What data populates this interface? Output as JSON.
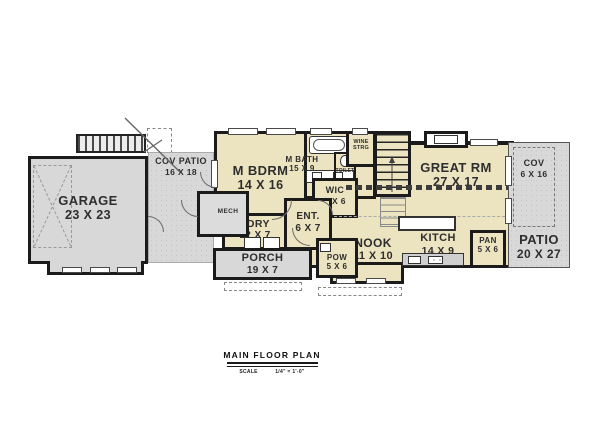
{
  "plan": {
    "title": "MAIN FLOOR PLAN",
    "scale_label": "SCALE",
    "scale_value": "1/4\" = 1'-0\""
  },
  "rooms": {
    "garage": {
      "name": "GARAGE",
      "dims": "23 X 23"
    },
    "cov_patio": {
      "name": "COV PATIO",
      "dims": "16 X 18"
    },
    "mech": {
      "name": "MECH"
    },
    "m_bdrm": {
      "name": "M BDRM",
      "dims": "14 X 16"
    },
    "m_bath": {
      "name": "M BATH",
      "dims": "15 X 9"
    },
    "toilet": {
      "name": "TOILET"
    },
    "wine_strg": {
      "line1": "WINE",
      "line2": "STRG"
    },
    "wic": {
      "name": "WIC",
      "dims": "9 X 6"
    },
    "great_rm": {
      "name": "GREAT RM",
      "dims": "27 X 17"
    },
    "ldry": {
      "name": "LDRY",
      "dims": "12 X 7"
    },
    "ent": {
      "name": "ENT.",
      "dims": "6 X 7"
    },
    "nook": {
      "name": "NOOK",
      "dims": "11 X 10"
    },
    "kitch": {
      "name": "KITCH",
      "dims": "14 X 9"
    },
    "pan": {
      "name": "PAN",
      "dims": "5 X 6"
    },
    "pow": {
      "name": "POW",
      "dims": "5 X 6"
    },
    "porch": {
      "name": "PORCH",
      "dims": "19 X 7"
    },
    "patio": {
      "name": "PATIO",
      "dims": "20 X 27"
    },
    "cov_right": {
      "name": "COV",
      "dims": "6 X 16"
    }
  },
  "colors": {
    "interior": "#ece4c0",
    "exterior": "#d8d8d8",
    "wall": "#1b1b1b"
  }
}
